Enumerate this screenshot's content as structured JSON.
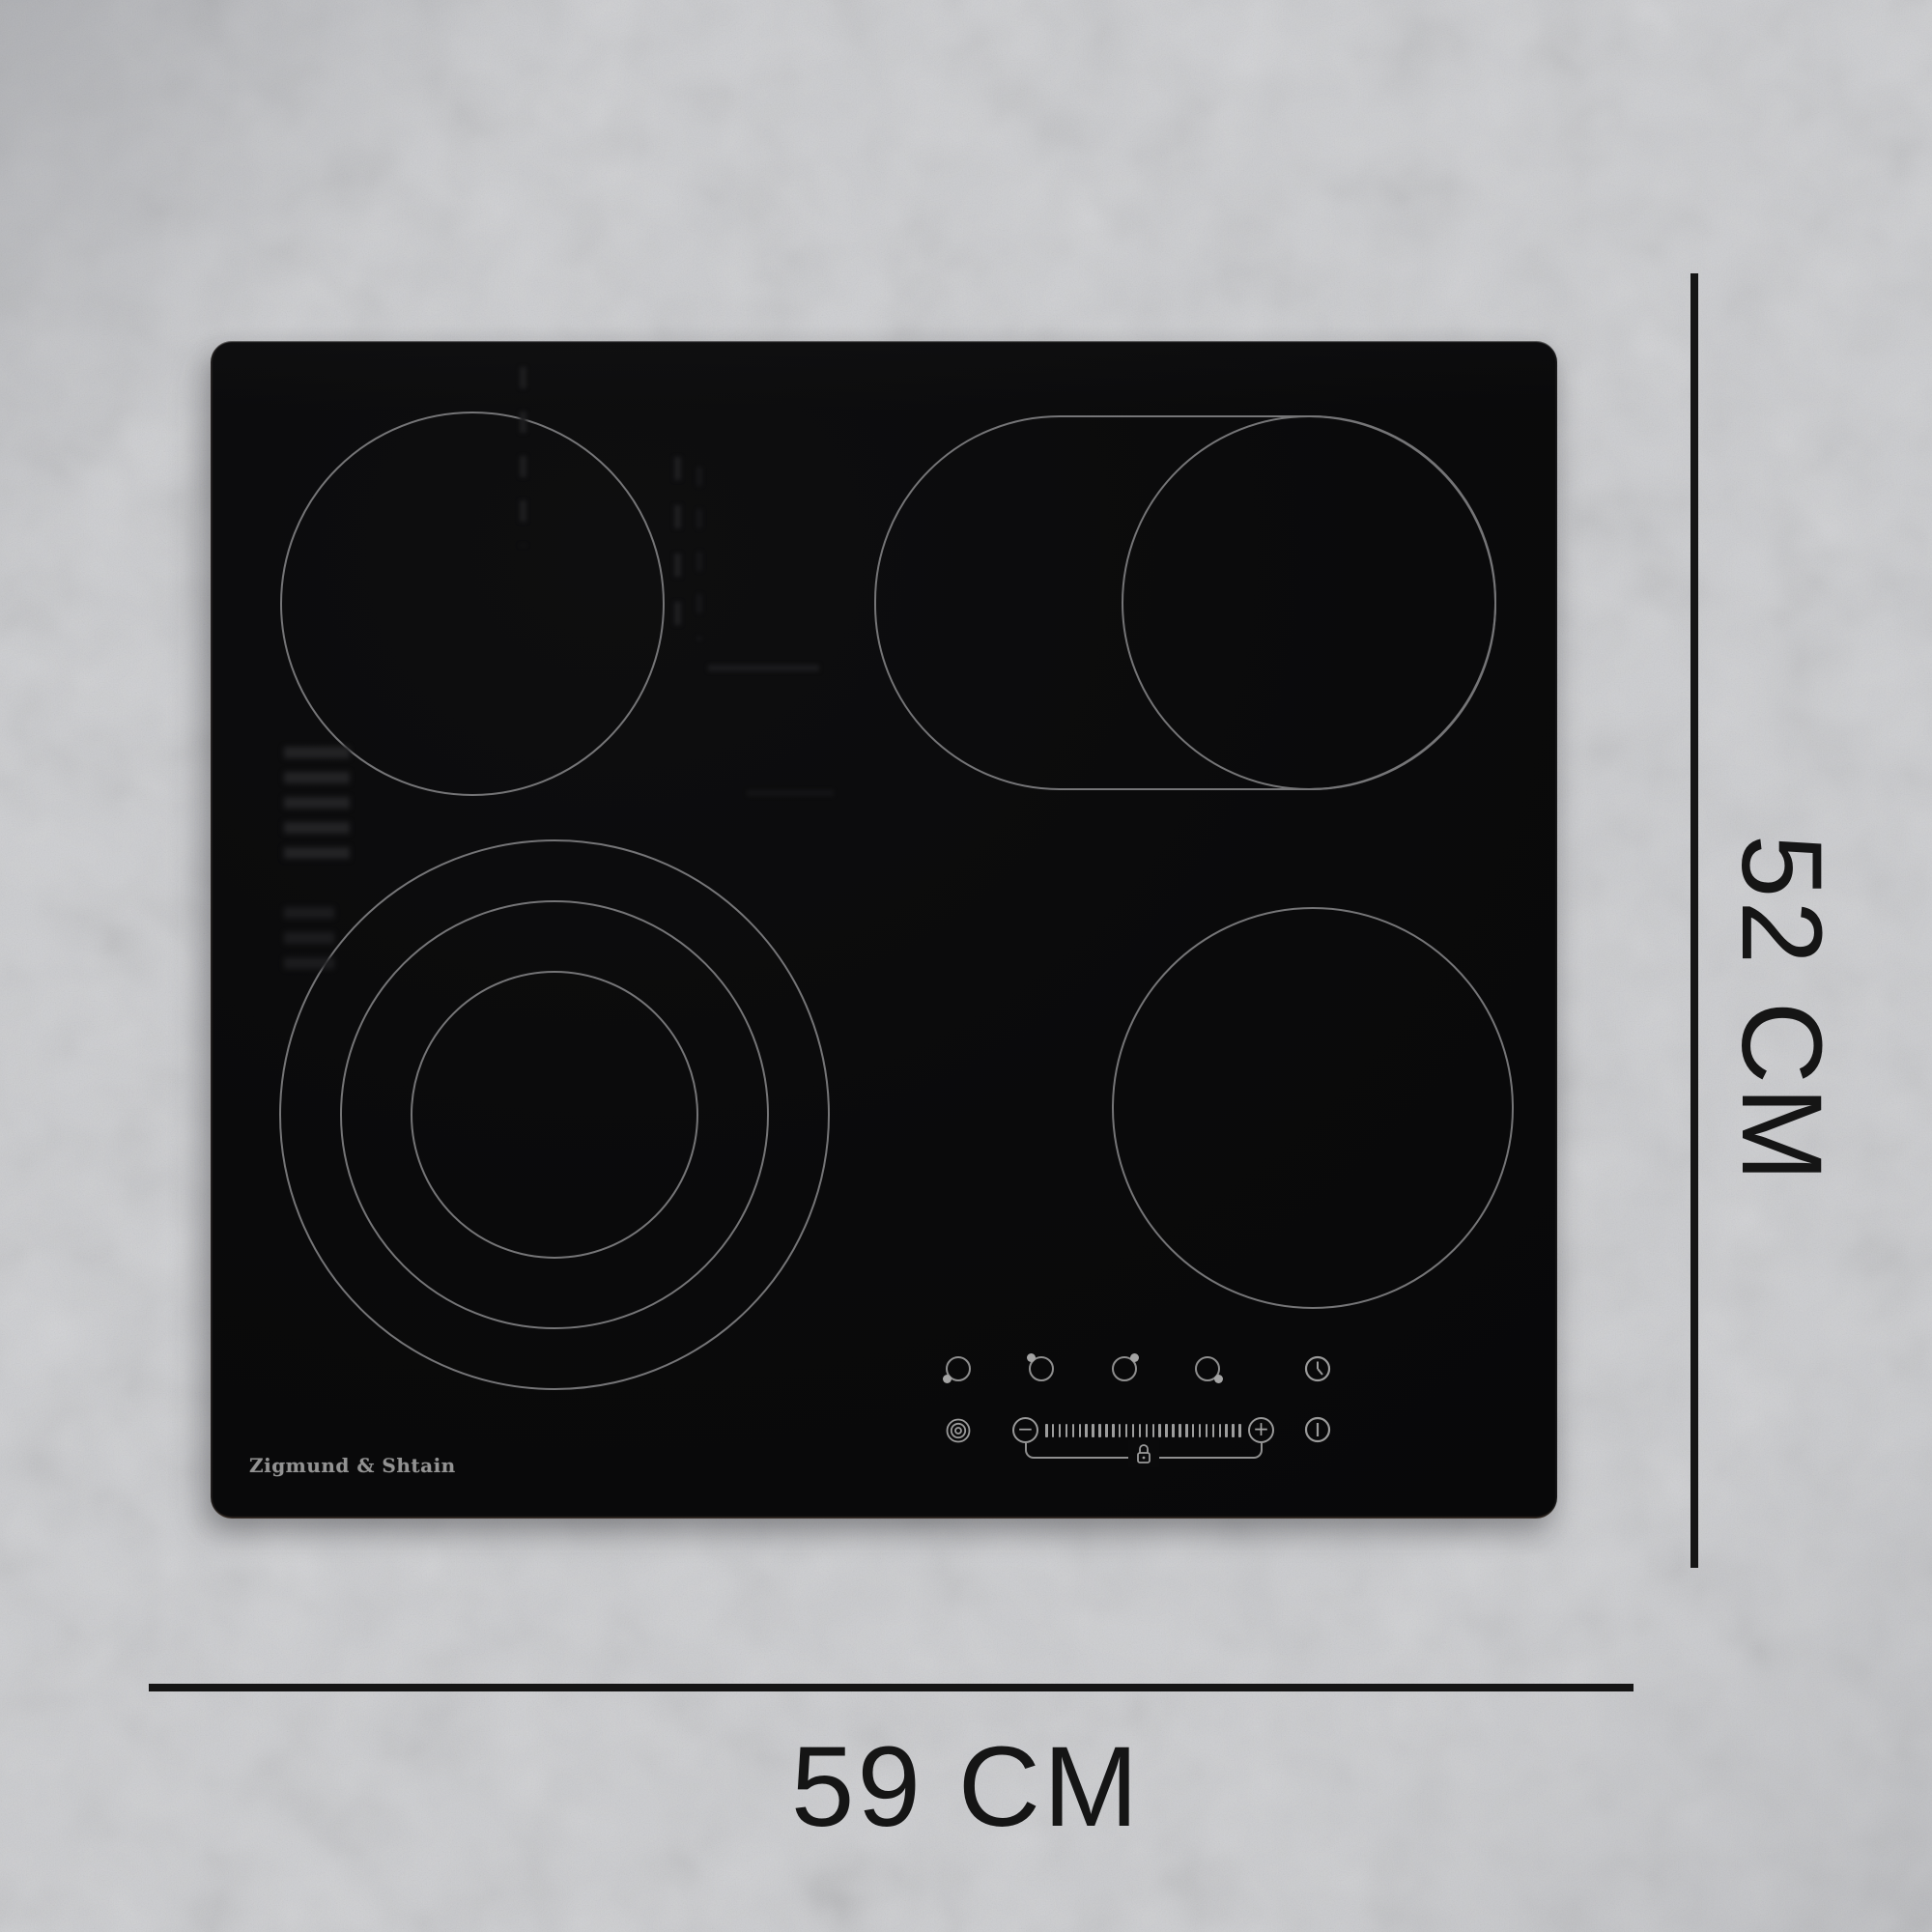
{
  "product": {
    "brand": "Zigmund & Shtain"
  },
  "dimensions": {
    "height_label": "52 CM",
    "width_label": "59 CM"
  },
  "hob": {
    "zones": [
      "single-circle-back-left",
      "oval-dual-zone-back-right",
      "single-circle-front-right",
      "triple-ring-zone-front-left"
    ]
  },
  "controls": {
    "burner_selectors": [
      {
        "icon": "burner-select-front-left-icon",
        "dot_position": "bottom-left"
      },
      {
        "icon": "burner-select-back-left-icon",
        "dot_position": "top-left"
      },
      {
        "icon": "burner-select-back-right-icon",
        "dot_position": "top-right"
      },
      {
        "icon": "burner-select-front-right-icon",
        "dot_position": "bottom-right"
      }
    ],
    "timer_icon": "clock-icon",
    "zone_extension_icon": "concentric-rings-icon",
    "minus_label": "−",
    "plus_label": "+",
    "power_icon": "power-icon",
    "lock_icon": "padlock-icon",
    "slider_tick_count": 30
  },
  "colors": {
    "background": "#cbcdcf",
    "hob": "#0a0a0b",
    "zone_outline": "#757577",
    "control_glyph": "#9a9a9a",
    "dimension_ink": "#151515",
    "brand_text": "#929292"
  }
}
